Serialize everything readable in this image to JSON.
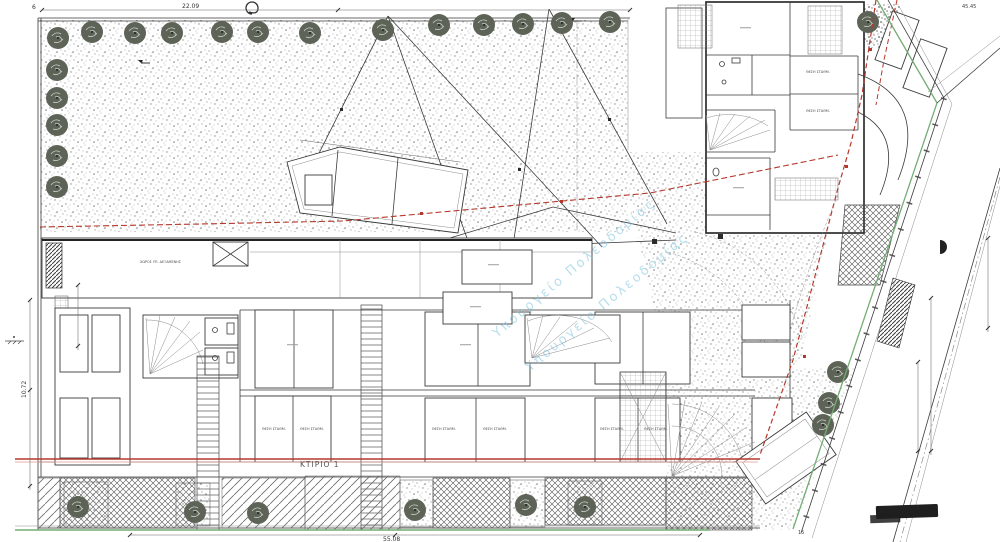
{
  "drawing": {
    "building_label": "ΚΤΙΡΙΟ 1",
    "basement_strip_label": "ΧΩΡΟΣ ΥΠ. ΔΕΞΑΜΕΝΗΣ",
    "parking_label": "ΘΕΣΗ ΣΤΑΘΜ.",
    "watermark_text": "Υπουργείο Πολεοδομίας"
  },
  "dimensions": {
    "top_width": "22.09",
    "bottom_width": "55.08",
    "left_height": "10.72",
    "corner_ref": "6",
    "top_right": "45.45",
    "road_width": "15"
  },
  "colors": {
    "boundary_red": "#b5382c",
    "road_green": "#74ad74",
    "watermark_cyan": "#7fc4de",
    "ink": "#3a3a3a",
    "tree_fill": "#5d6457"
  }
}
